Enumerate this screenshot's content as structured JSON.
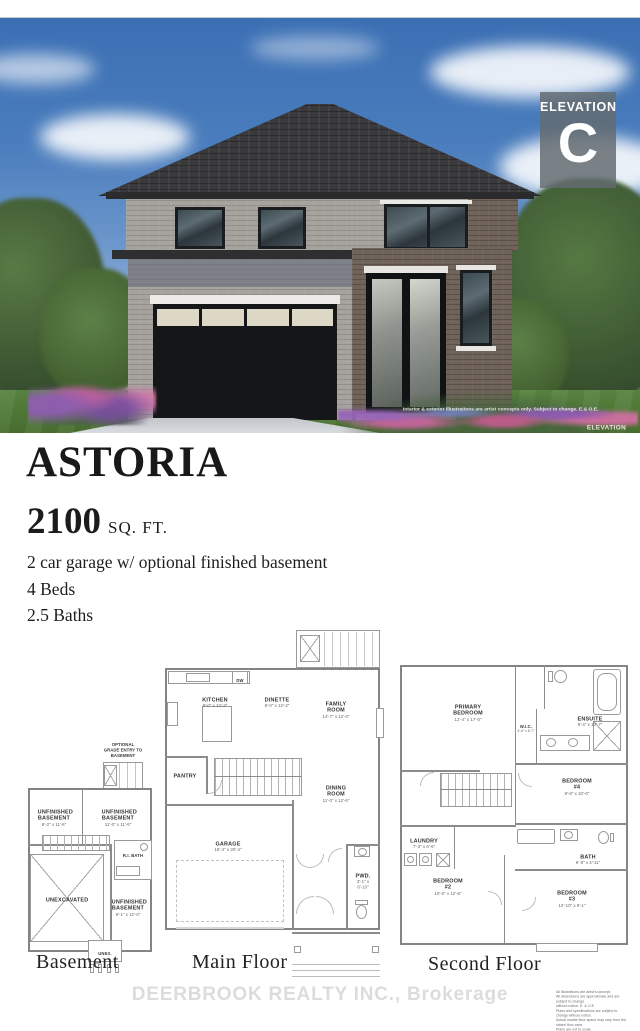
{
  "photo": {
    "badge_label": "ELEVATION",
    "badge_letter": "C",
    "disclaimer": "Interior & exterior illustrations are artist concepts only.  Subject to change.  E.& O.E.",
    "corner_label": "ELEVATION"
  },
  "listing": {
    "model_name": "ASTORIA",
    "area_value": "2100",
    "area_unit": "SQ. FT.",
    "features": [
      "2 car garage w/ optional finished basement",
      "4 Beds",
      "2.5 Baths"
    ]
  },
  "floorplans": {
    "basement": {
      "caption": "Basement",
      "optional_entry_note": "OPTIONAL\nGRADE ENTRY TO\nBASEMENT",
      "rooms": [
        {
          "name": "UNFINISHED\nBASEMENT",
          "dim": "9'-2\" x 11'-6\""
        },
        {
          "name": "UNFINISHED\nBASEMENT",
          "dim": "11'-0\" x 11'-6\""
        },
        {
          "name": "R.I. BATH",
          "dim": ""
        },
        {
          "name": "UNEXCAVATED",
          "dim": ""
        },
        {
          "name": "UNFINISHED\nBASEMENT",
          "dim": "8'-1\" x 12'-0\""
        },
        {
          "name": "UNEX.",
          "dim": ""
        }
      ]
    },
    "main_floor": {
      "caption": "Main Floor",
      "rooms": [
        {
          "name": "KITCHEN",
          "dim": "9'-0\" x 12'-2\""
        },
        {
          "name": "DINETTE",
          "dim": "9'-0\" x 12'-2\""
        },
        {
          "name": "FAMILY\nROOM",
          "dim": "14'-7\" x 12'-0\""
        },
        {
          "name": "PANTRY",
          "dim": ""
        },
        {
          "name": "DINING\nROOM",
          "dim": "11'-0\" x 12'-6\""
        },
        {
          "name": "GARAGE",
          "dim": "18'-4\" x 20'-4\""
        },
        {
          "name": "PWD.",
          "dim": "3'-1\" x 6'-10\""
        },
        {
          "name": "DW",
          "dim": ""
        }
      ]
    },
    "second_floor": {
      "caption": "Second Floor",
      "rooms": [
        {
          "name": "PRIMARY\nBEDROOM",
          "dim": "12'-4\" x 17'-0\""
        },
        {
          "name": "ENSUITE",
          "dim": "9'-4\" x 10'-7\""
        },
        {
          "name": "W.I.C.",
          "dim": "4'-6\" x 6'-7\""
        },
        {
          "name": "BEDROOM\n#4",
          "dim": "9'-8\" x 10'-0\""
        },
        {
          "name": "LAUNDRY",
          "dim": "7'-3\" x 6'-6\""
        },
        {
          "name": "BATH",
          "dim": "9'-8\" x 4'-11\""
        },
        {
          "name": "BEDROOM\n#2",
          "dim": "10'-0\" x 12'-6\""
        },
        {
          "name": "BEDROOM\n#3",
          "dim": "12'-10\" x 9'-1\""
        }
      ]
    }
  },
  "footer": {
    "watermark": "DEERBROOK REALTY INC., Brokerage",
    "fine_print": [
      "All illustrations are artist's concept.",
      "All dimensions are approximate and are subject to change",
      "without notice. E. & O.E.",
      "Plans and specifications are subject to change without notice.",
      "Actual usable floor space may vary from the stated floor area.",
      "Plans are not to scale."
    ]
  },
  "colors": {
    "sky": "#4a7dbd",
    "badge": "#666e74",
    "title_text": "#191919",
    "plan_line": "#9a9a9a",
    "watermark": "#dcdcdc"
  }
}
